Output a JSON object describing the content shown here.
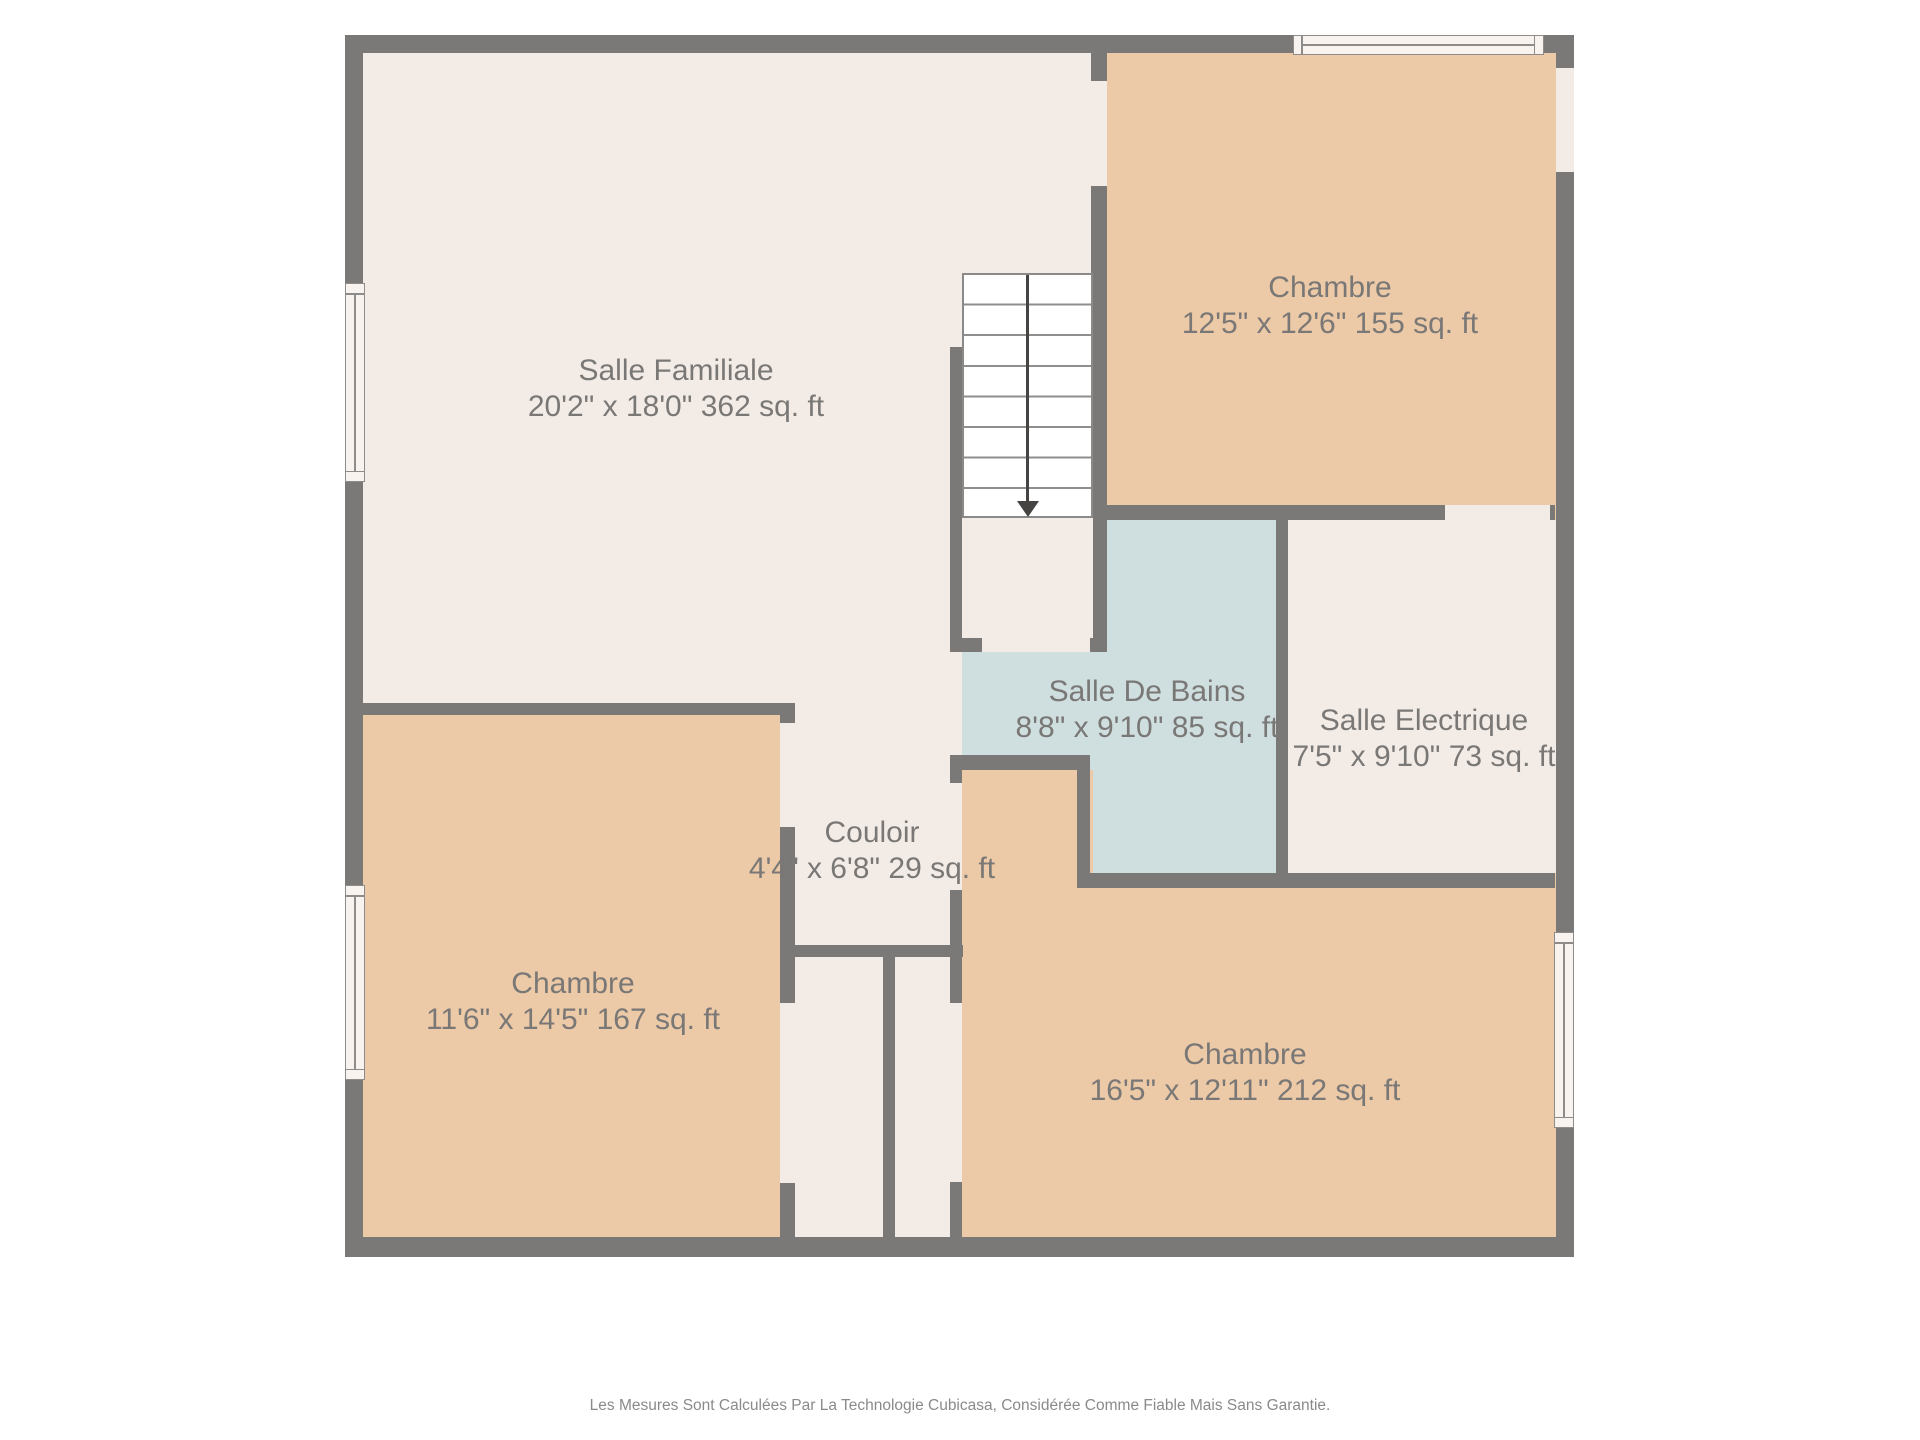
{
  "rooms": {
    "salle_familiale": {
      "name": "Salle Familiale",
      "dimensions": "20'2\" x 18'0\" 362 sq. ft"
    },
    "chambre_nord_est": {
      "name": "Chambre",
      "dimensions": "12'5\" x 12'6\" 155 sq. ft"
    },
    "salle_de_bains": {
      "name": "Salle De Bains",
      "dimensions": "8'8\" x 9'10\" 85 sq. ft"
    },
    "salle_electrique": {
      "name": "Salle Electrique",
      "dimensions": "7'5\" x 9'10\" 73 sq. ft"
    },
    "couloir": {
      "name": "Couloir",
      "dimensions": "4'4\" x 6'8\" 29 sq. ft"
    },
    "chambre_sud_ouest": {
      "name": "Chambre",
      "dimensions": "11'6\" x 14'5\" 167 sq. ft"
    },
    "chambre_sud_est": {
      "name": "Chambre",
      "dimensions": "16'5\" x 12'11\" 212 sq. ft"
    }
  },
  "stairs": {
    "steps": 8,
    "direction_arrow": "down"
  },
  "footer": {
    "disclaimer": "Les Mesures Sont Calculées Par La Technologie Cubicasa, Considérée Comme Fiable Mais Sans Garantie."
  },
  "colors": {
    "wall": "#7a7978",
    "room_default": "#f3ece6",
    "bedroom": "#ecc9a7",
    "bathroom": "#cfdede",
    "stair_fill": "#ffffff",
    "label_text": "#7a7876",
    "footer_text": "#8a8a8a"
  }
}
